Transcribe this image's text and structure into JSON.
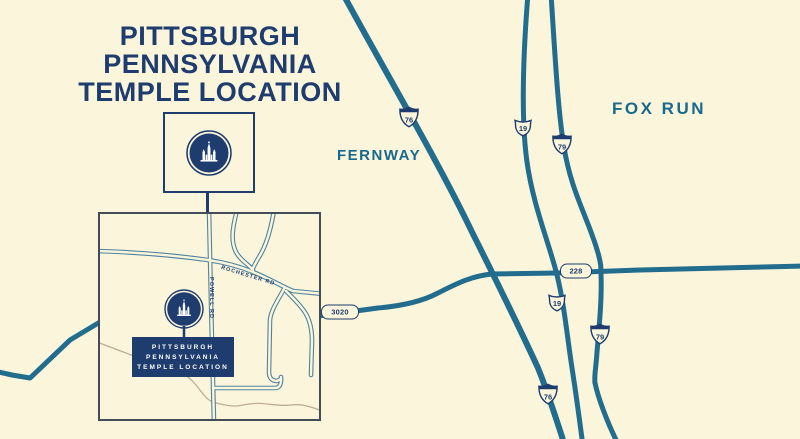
{
  "title": {
    "lines": [
      "PITTSBURGH",
      "PENNSYLVANIA",
      "TEMPLE LOCATION"
    ]
  },
  "areas": {
    "fernway": "FERNWAY",
    "fox_run": "FOX RUN"
  },
  "shields": [
    {
      "route": "I-76",
      "type": "interstate",
      "number": "76"
    },
    {
      "route": "US-19",
      "type": "us",
      "number": "19"
    },
    {
      "route": "I-79",
      "type": "interstate",
      "number": "79"
    },
    {
      "route": "PA-228",
      "type": "state-pill",
      "number": "228"
    },
    {
      "route": "US-19",
      "type": "us",
      "number": "19"
    },
    {
      "route": "I-79",
      "type": "interstate",
      "number": "79"
    },
    {
      "route": "I-76",
      "type": "interstate",
      "number": "76"
    },
    {
      "route": "PA-3020",
      "type": "state-pill",
      "number": "3020"
    }
  ],
  "inset": {
    "road_labels": {
      "rochester": "ROCHESTER RD",
      "powell": "POWELL RD"
    },
    "marker_label_lines": [
      "PITTSBURGH",
      "PENNSYLVANIA",
      "TEMPLE LOCATION"
    ]
  },
  "colors": {
    "background": "#FBF5DC",
    "highway_road": "#226D8E",
    "navy": "#1E3D6E",
    "area_text": "#17698E",
    "inset_road_casing": "#4E83A0",
    "creek": "#BCAE94",
    "inset_border": "#434D59"
  }
}
